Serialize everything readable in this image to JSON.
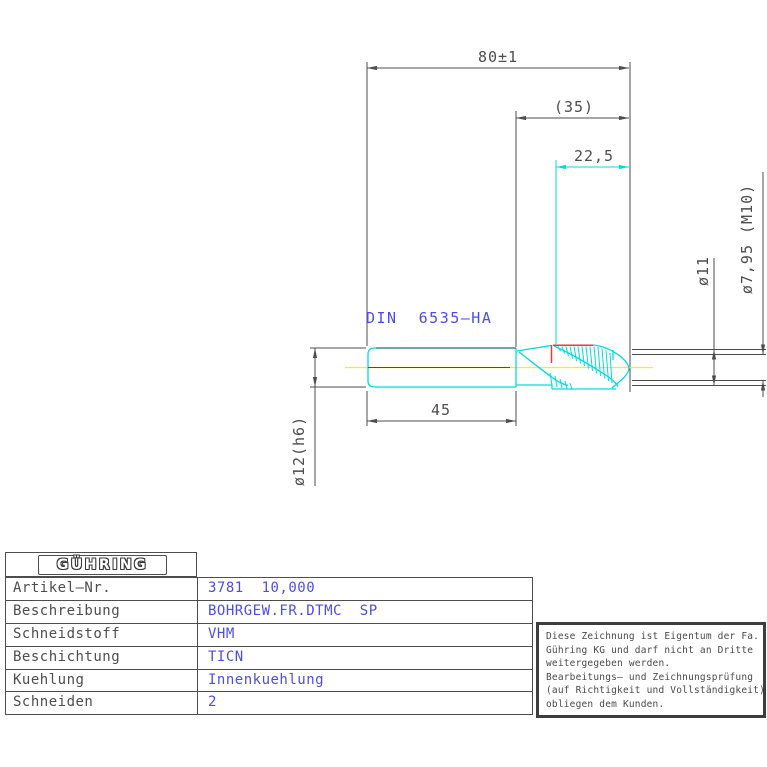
{
  "drawing": {
    "din_label": "DIN  6535–HA",
    "dimensions": {
      "overall_length": "80±1",
      "ref_length": "(35)",
      "thread_length": "22,5",
      "shank_length": "45",
      "shank_dia": "ø12(h6)",
      "step_dia": "ø11",
      "tip_dia": "ø7,95 (M10)"
    },
    "colors": {
      "tool_outline": "#00dcdc",
      "centerline": "#f5f500",
      "profile_highlight": "#e83a3a",
      "annotation_blue": "#4c4cee",
      "dimension_gray": "#4d4d4d"
    }
  },
  "table": {
    "logo": "GÜHRING",
    "rows": [
      {
        "label": "Artikel–Nr.",
        "value": "3781  10,000"
      },
      {
        "label": "Beschreibung",
        "value": "BOHRGEW.FR.DTMC  SP"
      },
      {
        "label": "Schneidstoff",
        "value": "VHM"
      },
      {
        "label": "Beschichtung",
        "value": "TICN"
      },
      {
        "label": "Kuehlung",
        "value": "Innenkuehlung"
      },
      {
        "label": "Schneiden",
        "value": "2"
      }
    ]
  },
  "note": {
    "lines": [
      "Diese Zeichnung ist Eigentum der Fa.",
      "Gühring KG und darf nicht an Dritte",
      "weitergegeben werden.",
      "Bearbeitungs– und Zeichnungsprüfung",
      "(auf Richtigkeit und Vollständigkeit)",
      "obliegen dem Kunden."
    ]
  }
}
